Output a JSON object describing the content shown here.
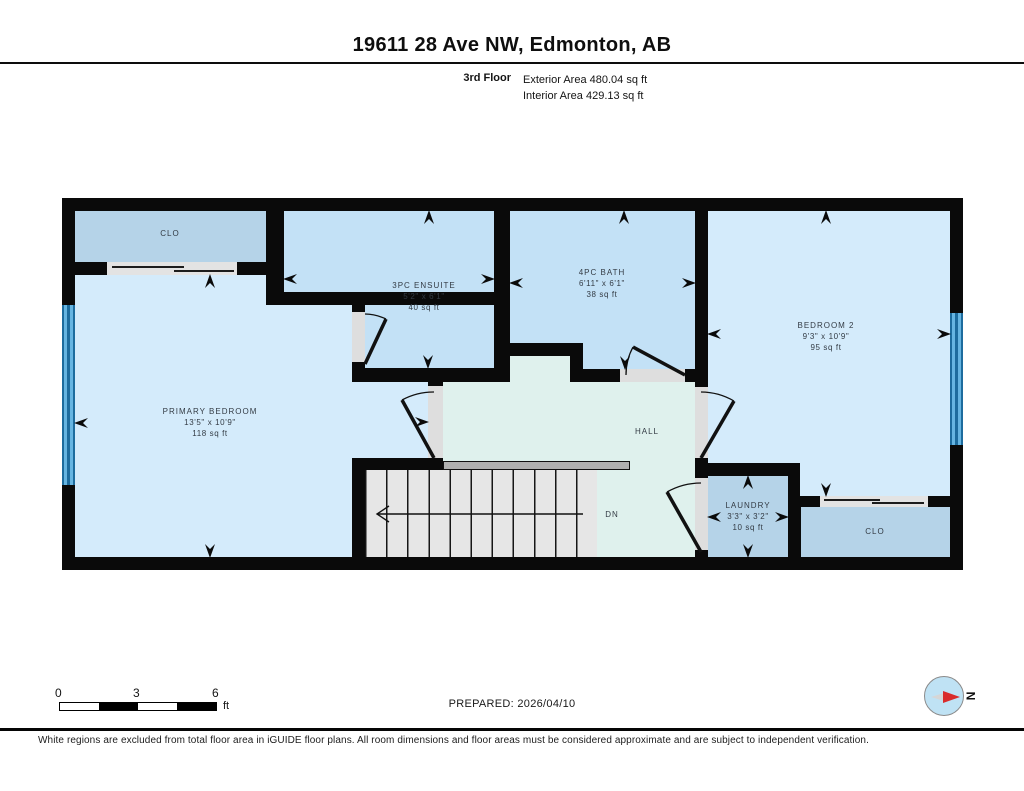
{
  "header": {
    "title": "19611 28 Ave NW, Edmonton, AB",
    "floor_label": "3rd Floor",
    "exterior_area": "Exterior Area 480.04 sq ft",
    "interior_area": "Interior Area 429.13 sq ft"
  },
  "rooms": {
    "clo_top": {
      "name": "CLO"
    },
    "primary": {
      "name": "PRIMARY BEDROOM",
      "dims": "13'5\" x 10'9\"",
      "area": "118 sq ft"
    },
    "ensuite": {
      "name": "3PC ENSUITE",
      "dims": "5'2\" x 6'1\"",
      "area": "40 sq ft"
    },
    "bath": {
      "name": "4PC BATH",
      "dims": "6'11\" x 6'1\"",
      "area": "38 sq ft"
    },
    "bedroom2": {
      "name": "BEDROOM 2",
      "dims": "9'3\" x 10'9\"",
      "area": "95 sq ft"
    },
    "hall": {
      "name": "HALL"
    },
    "laundry": {
      "name": "LAUNDRY",
      "dims": "3'3\" x 3'2\"",
      "area": "10 sq ft"
    },
    "clo_bottom": {
      "name": "CLO"
    },
    "stairs": {
      "direction_label": "DN"
    }
  },
  "scale_bar": {
    "tick_0": "0",
    "tick_3": "3",
    "tick_6": "6",
    "unit": "ft"
  },
  "footer": {
    "prepared": "PREPARED: 2026/04/10",
    "north_label": "N",
    "disclaimer": "White regions are excluded from total floor area in iGUIDE floor plans. All room dimensions and floor areas must be considered approximate and are subject to independent verification."
  },
  "colors": {
    "wall": "#0a0a0a",
    "bedroom": "#d4ebfb",
    "bath": "#c3e1f6",
    "closet": "#b5d3e8",
    "hall": "#dff1ed",
    "stairs": "#e6e6e6",
    "opening": "#dedede",
    "railing": "#b0b0b0",
    "label": "#333b44",
    "north": "#d92b2b",
    "compass": "#bfe2f4"
  }
}
